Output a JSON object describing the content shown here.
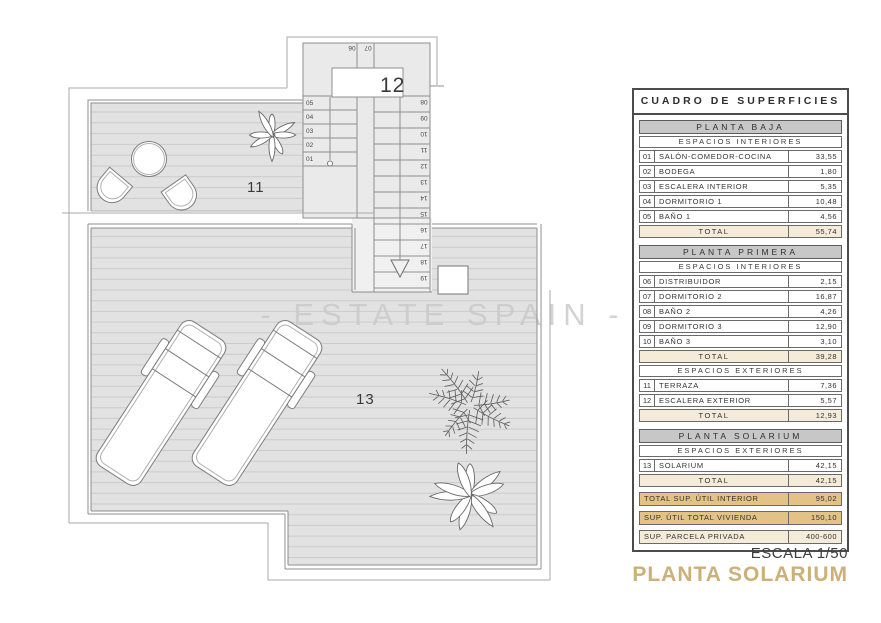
{
  "colors": {
    "accent_gold": "#cbb078",
    "summary_gold_bg": "#e3c285",
    "total_cream_bg": "#f4ebd9",
    "header_gray_bg": "#c7c7c7",
    "floor_gray": "#e2e2e2",
    "wall_line_gray": "#8f8f8f"
  },
  "plan": {
    "watermark": "- ESTATE SPAIN -",
    "labels": {
      "terrace": "11",
      "stairs": "12",
      "solarium": "13"
    },
    "stairs": {
      "top_steps": [
        "06",
        "07"
      ],
      "left_steps": [
        "05",
        "04",
        "03",
        "02",
        "01"
      ],
      "right_steps": [
        "08",
        "09",
        "10",
        "11",
        "12",
        "13",
        "14",
        "15",
        "16",
        "17",
        "18",
        "19"
      ]
    }
  },
  "table": {
    "title": "CUADRO DE SUPERFICIES",
    "total_label": "TOTAL",
    "sections": [
      {
        "title": "PLANTA BAJA",
        "groups": [
          {
            "subtitle": "ESPACIOS INTERIORES",
            "rows": [
              [
                "01",
                "SALÓN-COMEDOR-COCINA",
                "33,55"
              ],
              [
                "02",
                "BODEGA",
                "1,80"
              ],
              [
                "03",
                "ESCALERA INTERIOR",
                "5,35"
              ],
              [
                "04",
                "DORMITORIO 1",
                "10,48"
              ],
              [
                "05",
                "BAÑO 1",
                "4,56"
              ]
            ],
            "total": "55,74"
          }
        ]
      },
      {
        "title": "PLANTA PRIMERA",
        "groups": [
          {
            "subtitle": "ESPACIOS INTERIORES",
            "rows": [
              [
                "06",
                "DISTRIBUIDOR",
                "2,15"
              ],
              [
                "07",
                "DORMITORIO 2",
                "16,87"
              ],
              [
                "08",
                "BAÑO 2",
                "4,26"
              ],
              [
                "09",
                "DORMITORIO 3",
                "12,90"
              ],
              [
                "10",
                "BAÑO 3",
                "3,10"
              ]
            ],
            "total": "39,28"
          },
          {
            "subtitle": "ESPACIOS EXTERIORES",
            "rows": [
              [
                "11",
                "TERRAZA",
                "7,36"
              ],
              [
                "12",
                "ESCALERA EXTERIOR",
                "5,57"
              ]
            ],
            "total": "12,93"
          }
        ]
      },
      {
        "title": "PLANTA SOLARIUM",
        "groups": [
          {
            "subtitle": "ESPACIOS EXTERIORES",
            "rows": [
              [
                "13",
                "SOLARIUM",
                "42,15"
              ]
            ],
            "total": "42,15"
          }
        ]
      }
    ],
    "summary": [
      {
        "label": "TOTAL SUP. ÚTIL INTERIOR",
        "value": "95,02",
        "style": "gold"
      },
      {
        "label": "SUP. ÚTIL TOTAL VIVIENDA",
        "value": "150,10",
        "style": "gold"
      },
      {
        "label": "SUP. PARCELA PRIVADA",
        "value": "400-600",
        "style": "cream"
      }
    ]
  },
  "footer": {
    "scale": "ESCALA 1/50",
    "plan_title": "PLANTA SOLARIUM"
  }
}
